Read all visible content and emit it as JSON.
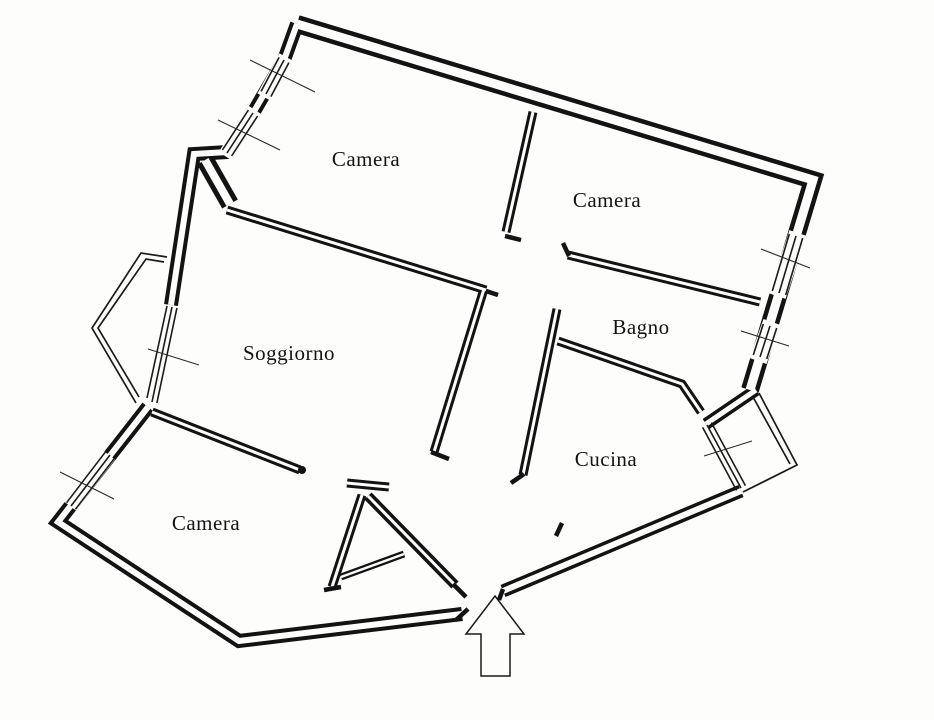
{
  "canvas": {
    "width": 934,
    "height": 720,
    "paper_color": "#fdfdfc",
    "ink_color": "#131313"
  },
  "floorplan": {
    "rooms": [
      {
        "id": "camera-nw",
        "label": "Camera",
        "x": 366,
        "y": 166
      },
      {
        "id": "camera-ne",
        "label": "Camera",
        "x": 607,
        "y": 207
      },
      {
        "id": "soggiorno",
        "label": "Soggiorno",
        "x": 289,
        "y": 360
      },
      {
        "id": "bagno",
        "label": "Bagno",
        "x": 641,
        "y": 334
      },
      {
        "id": "cucina",
        "label": "Cucina",
        "x": 606,
        "y": 466
      },
      {
        "id": "camera-sw",
        "label": "Camera",
        "x": 206,
        "y": 530
      }
    ],
    "entrance_arrow": {
      "direction": "up"
    }
  }
}
